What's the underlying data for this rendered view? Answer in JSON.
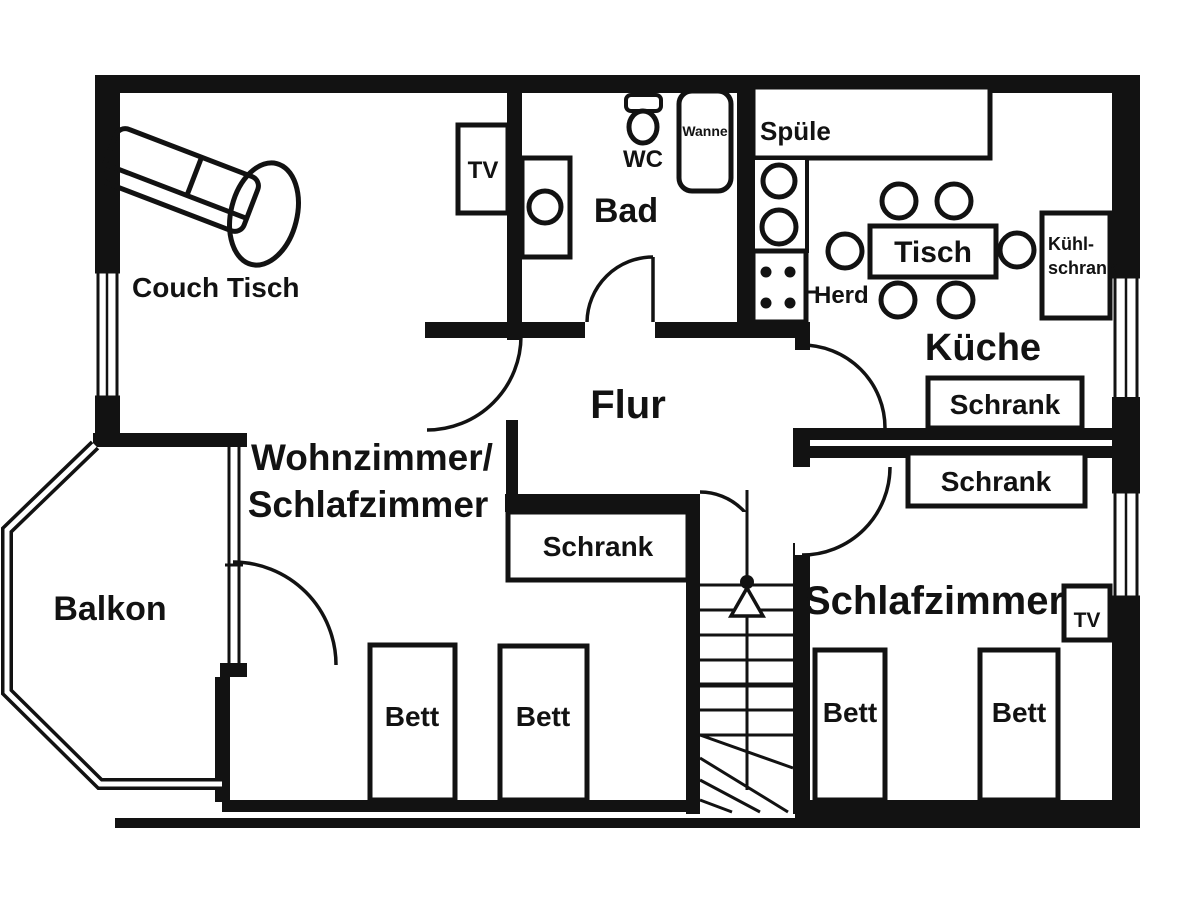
{
  "page": {
    "background": "#ffffff",
    "line_color": "#121212",
    "type": "apartment floor plan"
  },
  "rooms": {
    "living_room": {
      "label_line1": "Wohnzimmer/",
      "label_line2": "Schlafzimmer"
    },
    "hallway": {
      "label": "Flur"
    },
    "kitchen": {
      "label": "Küche"
    },
    "bathroom": {
      "label": "Bad"
    },
    "bedroom": {
      "label": "Schlafzimmer"
    },
    "balcony": {
      "label": "Balkon"
    }
  },
  "furniture": {
    "couch_table_label": "Couch Tisch",
    "tv_label": "TV",
    "wc_label": "WC",
    "bathtub_label": "Wanne",
    "kitchen_sink_label": "Spüle",
    "stove_label": "Herd",
    "dining_table_label": "Tisch",
    "fridge_label_line1": "Kühl-",
    "fridge_label_line2": "schrank",
    "wardrobe_label": "Schrank",
    "bed_label": "Bett"
  }
}
